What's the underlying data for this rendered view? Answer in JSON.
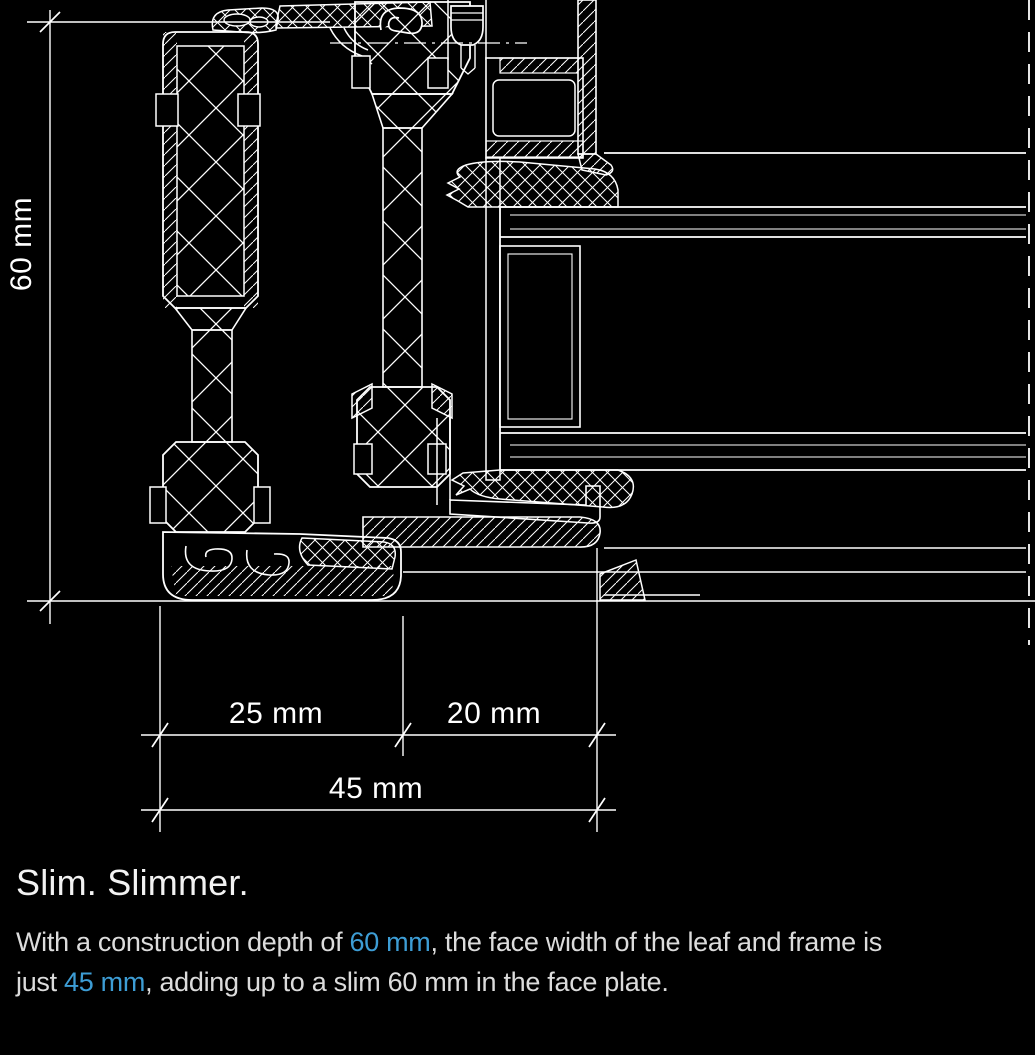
{
  "meta": {
    "background_color": "#000000",
    "line_color": "#ffffff",
    "accent_color": "#3d9dd5",
    "body_text_color": "#dcdcdc"
  },
  "diagram": {
    "type": "technical-cross-section",
    "subject": "window frame and leaf profile section with insulating glazing",
    "dimensions": [
      {
        "id": "construction-depth",
        "label": "60 mm",
        "orientation": "vertical"
      },
      {
        "id": "frame-face-width",
        "label": "25 mm",
        "orientation": "horizontal"
      },
      {
        "id": "leaf-face-width",
        "label": "20 mm",
        "orientation": "horizontal"
      },
      {
        "id": "total-face-width",
        "label": "45 mm",
        "orientation": "horizontal"
      }
    ]
  },
  "content": {
    "heading": "Slim. Slimmer.",
    "paragraph_lines": [
      [
        {
          "t": "With a construction depth of "
        },
        {
          "t": "60 mm",
          "hl": true
        },
        {
          "t": ", the face width of the leaf and frame is"
        }
      ],
      [
        {
          "t": "just "
        },
        {
          "t": "45 mm",
          "hl": true
        },
        {
          "t": ", adding up to a slim 60 mm in the face plate."
        }
      ]
    ]
  }
}
